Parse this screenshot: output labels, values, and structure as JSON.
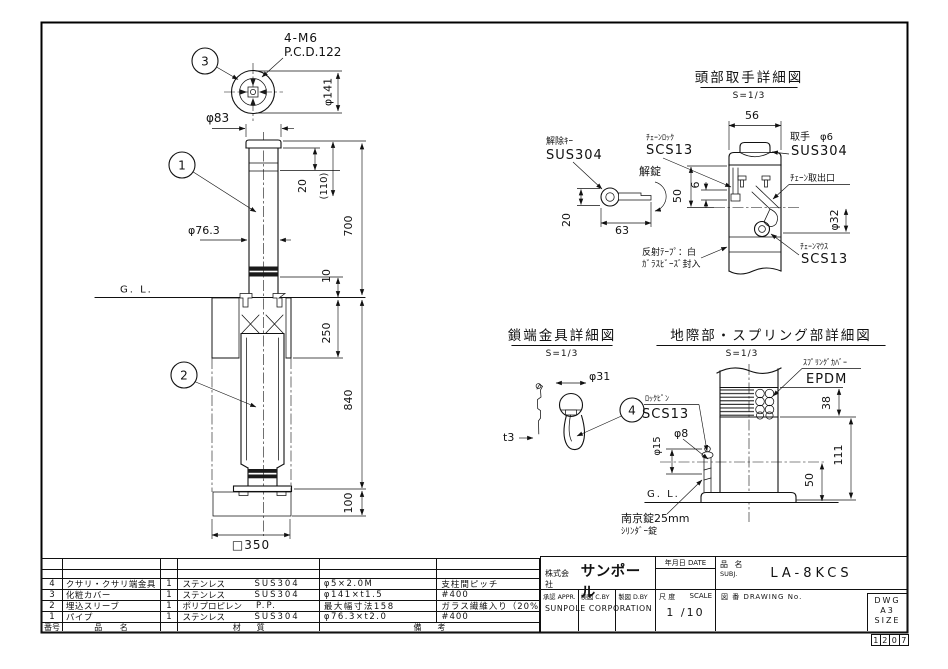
{
  "main_view": {
    "balloons": {
      "b1": "1",
      "b2": "2",
      "b3": "3"
    },
    "top_view": {
      "note1": "4-M6",
      "note2": "P.C.D.122",
      "dia_flange": "φ141"
    },
    "dims": {
      "dia83": "φ83",
      "dia763": "φ76.3",
      "d20": "20",
      "d110": "(110)",
      "d700": "700",
      "d10": "10",
      "d250": "250",
      "d840": "840",
      "d100": "100",
      "sq350": "□350"
    },
    "gl_label": "G. L."
  },
  "head_detail": {
    "title": "頭部取手詳細図",
    "scale": "S=1/3",
    "release_key_label": "解除ｷｰ",
    "release_key_material": "SUS304",
    "unlock": "解錠",
    "chain_lock_label": "ﾁｪｰﾝﾛｯｸ",
    "chain_lock_material": "SCS13",
    "handle_label": "取手　φ6",
    "handle_material": "SUS304",
    "chain_outlet_label": "ﾁｪｰﾝ取出口",
    "chain_mouth_label": "ﾁｪｰﾝﾏｳｽ",
    "chain_mouth_material": "SCS13",
    "tape_note1": "反射ﾃｰﾌﾟ：白",
    "tape_note2": "ｶﾞﾗｽﾋﾞｰｽﾞ封入",
    "dims": {
      "d56": "56",
      "d50": "50",
      "d6": "6",
      "d20": "20",
      "d63": "63",
      "dia32": "φ32"
    }
  },
  "chain_detail": {
    "title": "鎖端金具詳細図",
    "scale": "S=1/3",
    "balloon": "4",
    "dims": {
      "dia31": "φ31",
      "t3": "t3"
    }
  },
  "ground_detail": {
    "title": "地際部・スプリング部詳細図",
    "scale": "S=1/3",
    "spring_cover_label": "ｽﾌﾟﾘﾝｸﾞｶﾊﾞｰ",
    "spring_cover_material": "EPDM",
    "lock_pin_label": "ﾛｯｸﾋﾟﾝ",
    "lock_pin_material": "SCS13",
    "padlock_note1": "南京錠25mm",
    "padlock_note2": "ｼﾘﾝﾀﾞｰ錠",
    "gl_label": "G. L.",
    "dims": {
      "d38": "38",
      "d111": "111",
      "d50": "50",
      "dia8": "φ8",
      "dia15": "φ15"
    }
  },
  "parts_table": {
    "headers": {
      "no": "番号",
      "name": "品　　名",
      "material": "材　　質",
      "remarks": "備　　考"
    },
    "rows": [
      {
        "no": "4",
        "name": "クサリ・クサリ端金具",
        "qty": "1",
        "material": "ステンレス",
        "grade": "SUS304",
        "spec": "φ5×2.0M",
        "note": "支柱間ピッチ"
      },
      {
        "no": "3",
        "name": "化粧カバー",
        "qty": "1",
        "material": "ステンレス",
        "grade": "SUS304",
        "spec": "φ141×t1.5",
        "note": "#400"
      },
      {
        "no": "2",
        "name": "埋込スリーブ",
        "qty": "1",
        "material": "ポリプロピレン",
        "grade": "P.P.",
        "spec": "最大幅寸法158",
        "note": "ガラス繊維入り（20%）"
      },
      {
        "no": "1",
        "name": "パイプ",
        "qty": "1",
        "material": "ステンレス",
        "grade": "SUS304",
        "spec": "φ76.3×t2.0",
        "note": "#400"
      }
    ]
  },
  "title_block": {
    "company_prefix": "株式会社",
    "company_name": "サンポール",
    "company_en": "SUNPOLE CORPORATION",
    "approvals": [
      "承認 APPR.",
      "検図 C.BY",
      "製図 D.BY"
    ],
    "date_label": "年月日 DATE",
    "subject_label": "品 名",
    "subject_sub": "SUBJ.",
    "product_code": "LA-8KCS",
    "scale_label_jp": "尺 度",
    "scale_label_en": "SCALE",
    "scale_value": "1 /10",
    "dwg_no_label": "図 番 DRAWING No.",
    "size_lines": [
      "DWG",
      "A3",
      "SIZE"
    ],
    "stamp_digits": [
      "1",
      "2",
      "0",
      "7"
    ]
  }
}
